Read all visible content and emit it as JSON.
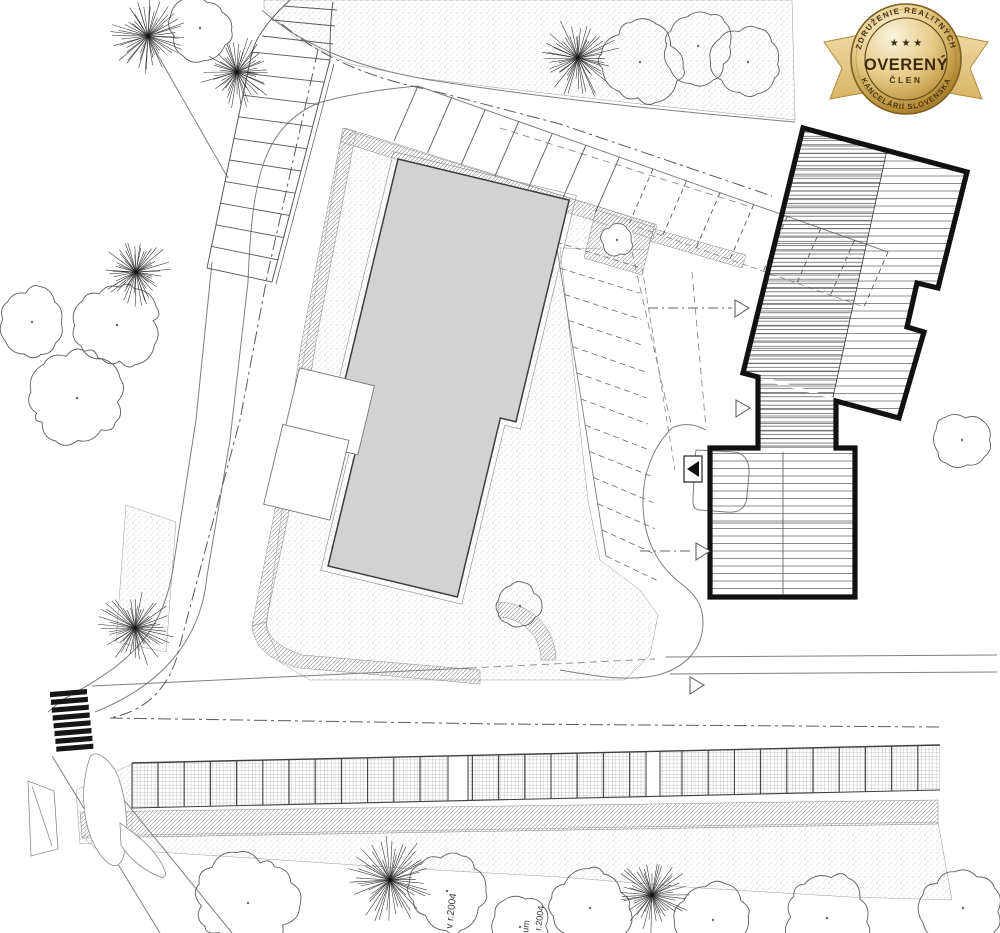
{
  "badge": {
    "top_arc": "ZDRUŽENIE REALITNÝCH",
    "bottom_arc": "KANCELÁRIÍ SLOVENSKA",
    "title": "OVERENÝ",
    "subtitle": "ČLEN",
    "stars": "★ ★ ★",
    "colors": {
      "gold_light": "#faf3dc",
      "gold": "#e7cc8a",
      "gold_deep": "#b98e38",
      "gold_dark": "#8a671f",
      "text": "#3b2a0c",
      "ribbon_light": "#eed9a2",
      "ribbon": "#d9b467",
      "ribbon_edge": "#b08c3c"
    }
  },
  "plan": {
    "labels": [
      {
        "text": "v r.2004",
        "x": 452,
        "y": 929,
        "rot": -83,
        "fs": 10
      },
      {
        "text": "um",
        "x": 528,
        "y": 933,
        "rot": -83,
        "fs": 9
      },
      {
        "text": "r.2004",
        "x": 541,
        "y": 931,
        "rot": -83,
        "fs": 9
      }
    ],
    "colors": {
      "building_fill": "#d2d2d2",
      "bold_outline": "#111111",
      "line": "#3f3f3f",
      "curb": "#7f7f7f",
      "dash": "#8a8a8a",
      "tree": "#5f5f5f",
      "conifer": "#2a2a2a",
      "crosswalk": "#161616",
      "label": "#3a3a3a"
    },
    "parking": {
      "top_row_stalls": 15,
      "left_ladder_stalls": 11,
      "side_column_stalls": 13,
      "bottom_row_divider_step": 26.2,
      "crosswalk_stripes": 8
    },
    "trees": {
      "conifer": [
        [
          148,
          36,
          40
        ],
        [
          237,
          72,
          38
        ],
        [
          136,
          272,
          36
        ],
        [
          578,
          58,
          42
        ],
        [
          135,
          628,
          40
        ],
        [
          390,
          880,
          46
        ],
        [
          652,
          895,
          40
        ]
      ],
      "deciduous": [
        [
          200,
          28,
          30
        ],
        [
          640,
          62,
          40
        ],
        [
          698,
          46,
          36
        ],
        [
          748,
          62,
          34
        ],
        [
          117,
          325,
          42
        ],
        [
          32,
          322,
          34
        ],
        [
          77,
          398,
          44
        ],
        [
          520,
          606,
          22
        ],
        [
          617,
          240,
          16
        ],
        [
          962,
          440,
          26
        ],
        [
          248,
          903,
          48
        ],
        [
          447,
          891,
          38
        ],
        [
          520,
          927,
          30
        ],
        [
          590,
          908,
          40
        ],
        [
          713,
          920,
          36
        ],
        [
          827,
          918,
          42
        ],
        [
          963,
          908,
          40
        ]
      ]
    }
  }
}
